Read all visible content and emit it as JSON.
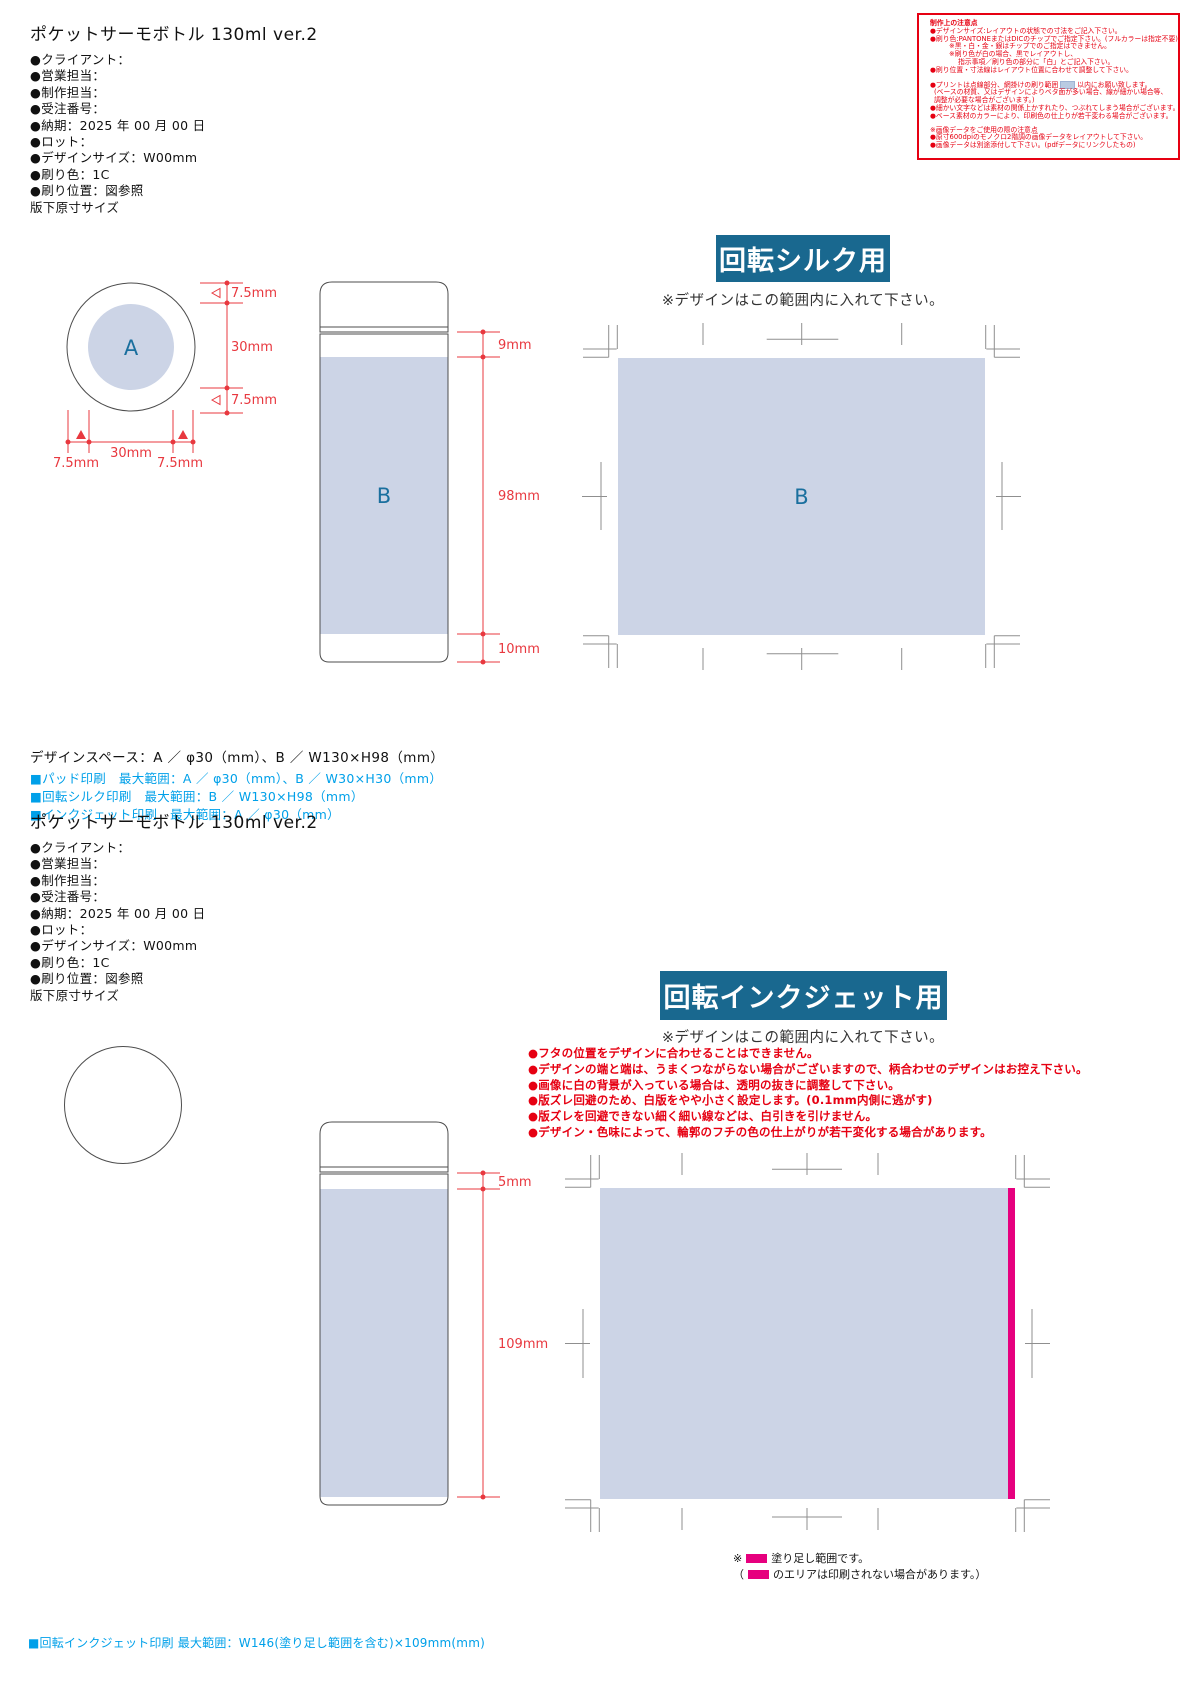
{
  "section1": {
    "title": "ポケットサーモボトル 130ml  ver.2",
    "spec_lines": [
      "●クライアント：",
      "●営業担当：",
      "●制作担当：",
      "●受注番号：",
      "●納期：2025 年 00 月 00 日",
      "●ロット：",
      "●デザインサイズ：W00mm",
      "●刷り色：1C",
      "●刷り位置：図参照",
      "版下原寸サイズ"
    ],
    "banner": "回転シルク用",
    "banner_note": "※デザインはこの範囲内に入れて下さい。",
    "design_space": "デザインスペース：A ／ φ30（mm）、B ／ W130×H98（mm）",
    "print_ranges": [
      "■パッド印刷　最大範囲：A ／ φ30（mm）、B ／ W30×H30（mm）",
      "■回転シルク印刷　最大範囲：B ／ W130×H98（mm）",
      "■インクジェット印刷　最大範囲：A ／ φ30（mm）"
    ]
  },
  "notes_box": {
    "title": "制作上の注意点",
    "lines_a": [
      "●デザインサイズ:レイアウトの状態での寸法をご記入下さい。",
      "●刷り色:PANTONEまたはDICのチップでご指定下さい。(フルカラーは指定不要)",
      "※黒・白・金・銀はチップでのご指定はできません。",
      "※刷り色が白の場合、黒でレイアウトし、",
      "指示事項／刷り色の部分に「白」とご記入下さい。",
      "●刷り位置・寸法線はレイアウト位置に合わせて調整して下さい。"
    ],
    "print_line_pre": "●プリントは点線部分、網掛けの刷り範囲",
    "print_line_post": "以内にお願い致します。",
    "lines_b": [
      "(ベースの材質、又はデザインによりベタ面が多い場合、線が細かい場合等、",
      "調整が必要な場合がございます。)",
      "●細かい文字などは素材の関係上かすれたり、つぶれてしまう場合がございます。",
      "●ベース素材のカラーにより、印刷色の仕上りが若干変わる場合がございます。"
    ],
    "lines_c": [
      "※画像データをご使用の際の注意点",
      "●原寸600dpiのモノクロ2階調の画像データをレイアウトして下さい。",
      "●画像データは別途添付して下さい。(pdfデータにリンクしたもの)"
    ]
  },
  "diagram1": {
    "cap_label": "A",
    "body_label": "B",
    "big_area_label": "B",
    "circle_dims": {
      "top": "7.5mm",
      "middle": "30mm",
      "bottom": "7.5mm",
      "left": "7.5mm",
      "center": "30mm",
      "right": "7.5mm"
    },
    "bottle_dims": {
      "top": "9mm",
      "middle": "98mm",
      "bottom": "10mm"
    }
  },
  "section2": {
    "title": "ポケットサーモボトル 130ml  ver.2",
    "spec_lines": [
      "●クライアント：",
      "●営業担当：",
      "●制作担当：",
      "●受注番号：",
      "●納期：2025 年 00 月 00 日",
      "●ロット：",
      "●デザインサイズ：W00mm",
      "●刷り色：1C",
      "●刷り位置：図参照",
      "版下原寸サイズ"
    ],
    "banner": "回転インクジェット用",
    "banner_note": "※デザインはこの範囲内に入れて下さい。",
    "warnings": [
      "●フタの位置をデザインに合わせることはできません。",
      "●デザインの端と端は、うまくつながらない場合がございますので、柄合わせのデザインはお控え下さい。",
      "●画像に白の背景が入っている場合は、透明の抜きに調整して下さい。",
      "●版ズレ回避のため、白版をやや小さく設定します。(0.1mm内側に逃がす)",
      "●版ズレを回避できない細く細い線などは、白引きを引けません。",
      "●デザイン・色味によって、輪郭のフチの色の仕上がりが若干変化する場合があります。"
    ],
    "bottle_dims": {
      "top": "5mm",
      "middle": "109mm"
    },
    "legend_line1_pre": "※",
    "legend_line1_post": "塗り足し範囲です。",
    "legend_line2_pre": "（",
    "legend_line2_post": "のエリアは印刷されない場合があります。）",
    "footer": "■回転インクジェット印刷 最大範囲：W146(塗り足し範囲を含む)×109mm(mm)"
  },
  "colors": {
    "banner_blue": "#19688f",
    "print_area_fill": "#ccd4e6",
    "dimension_red": "#e8383f",
    "note_red": "#e60012",
    "bleed_magenta": "#e6007e",
    "range_cyan": "#00a0e9",
    "crop_mark_gray": "#8f8f8f"
  }
}
